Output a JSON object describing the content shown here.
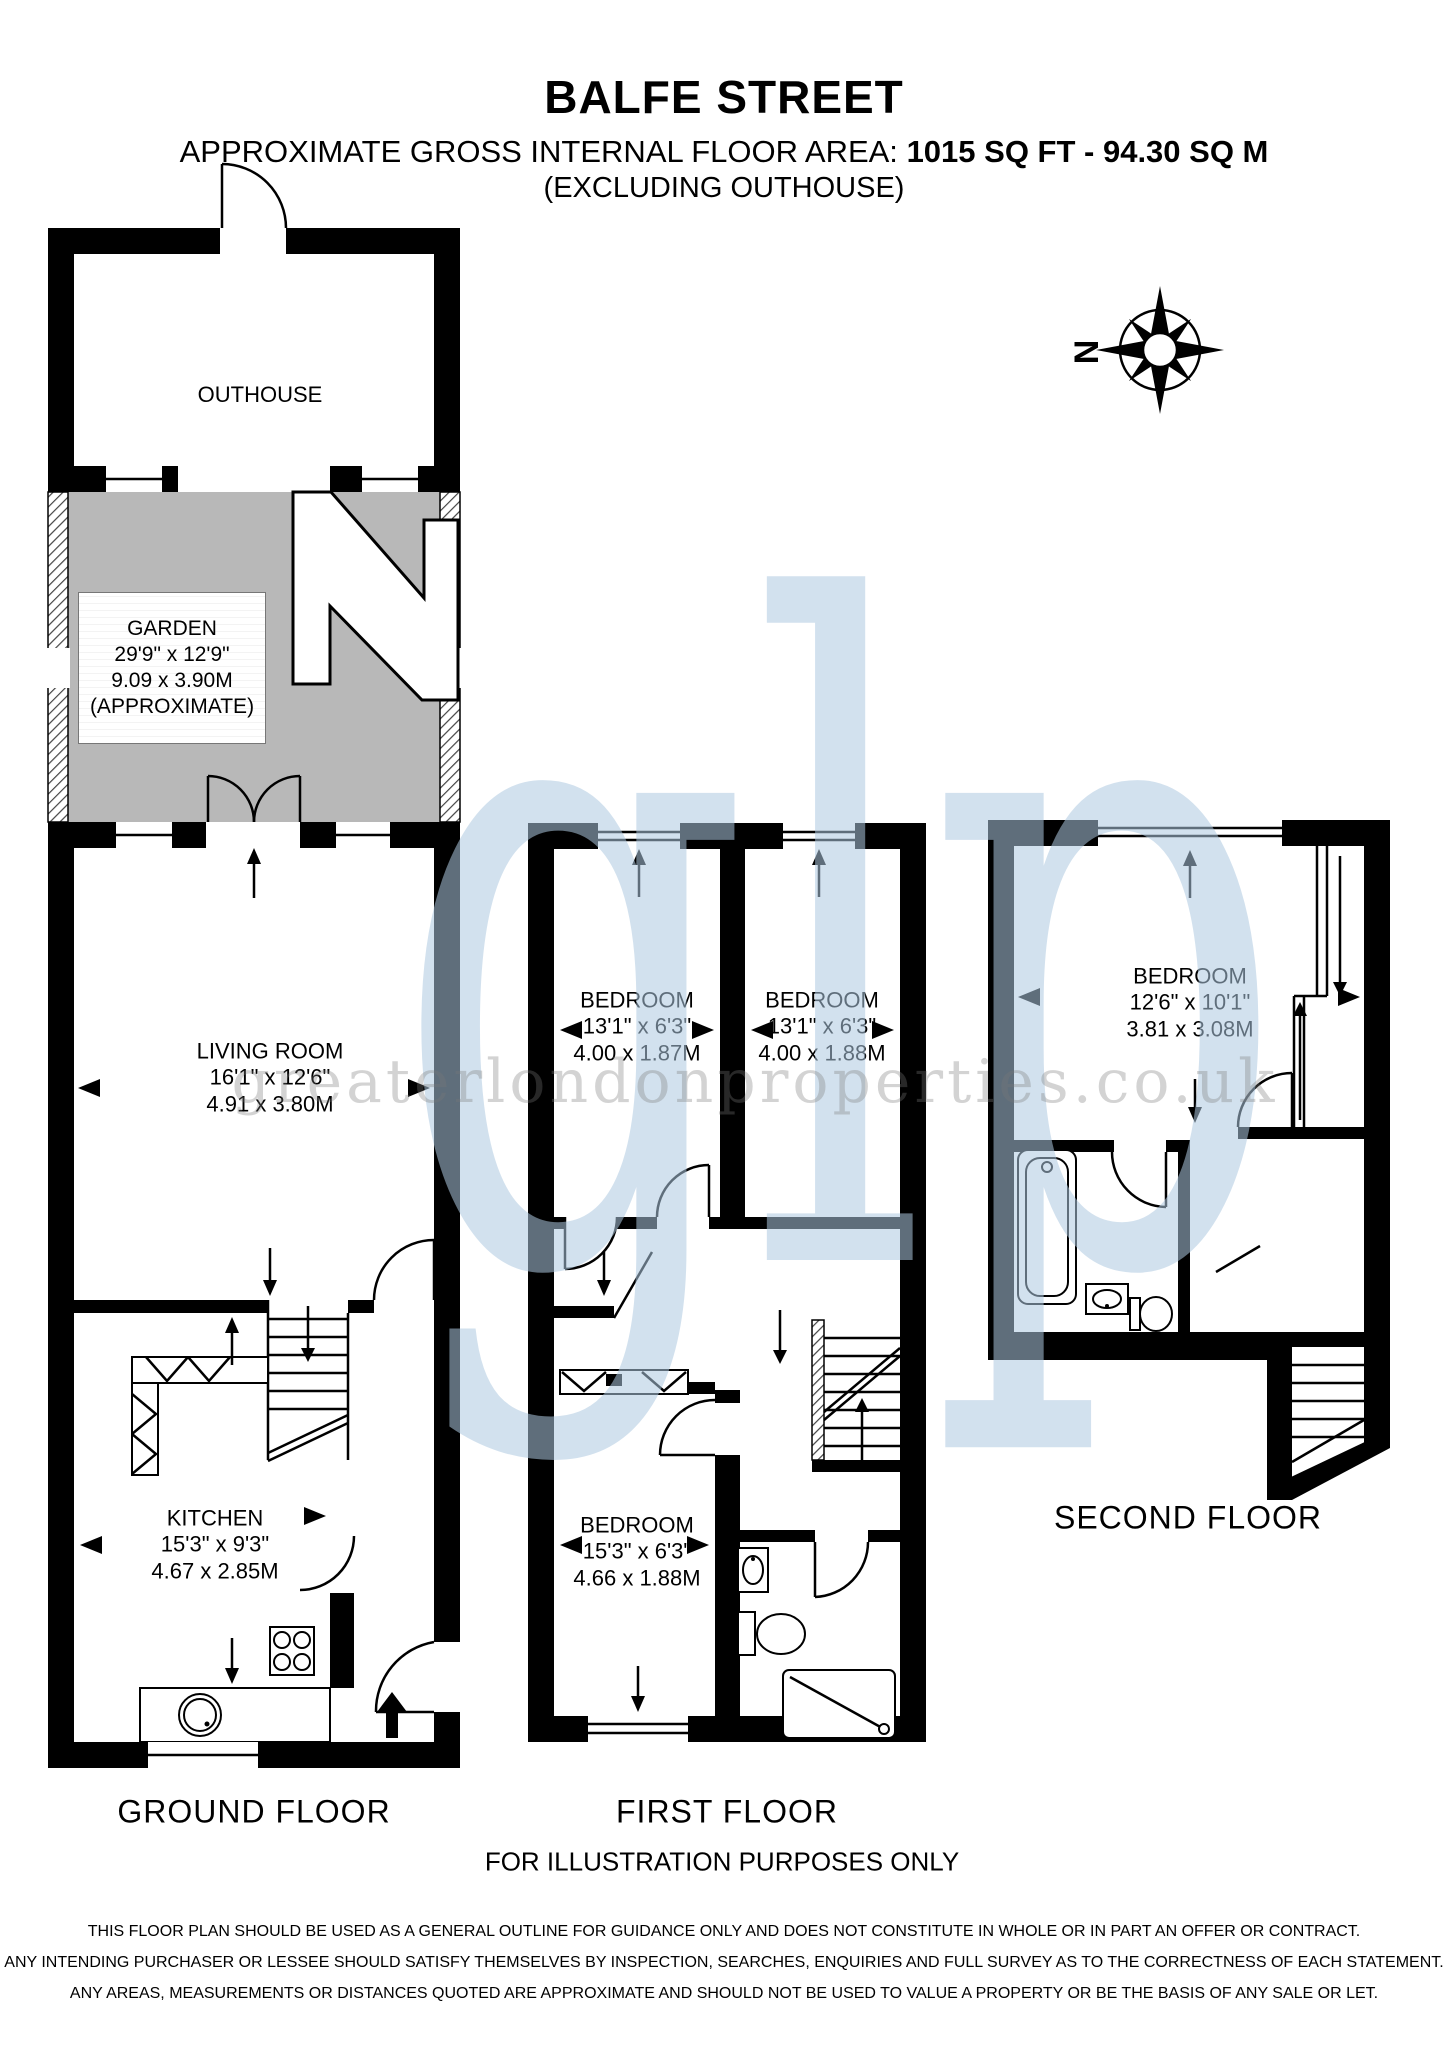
{
  "header": {
    "title": "BALFE STREET",
    "area_prefix": "APPROXIMATE GROSS INTERNAL FLOOR AREA:",
    "area_value": "1015 SQ FT - 94.30 SQ M",
    "exclusion_note": "(EXCLUDING OUTHOUSE)"
  },
  "compass": {
    "north_label": "N"
  },
  "watermark": {
    "monogram": "glp",
    "website": "greaterlondonproperties.co.uk"
  },
  "ground_floor": {
    "label": "GROUND FLOOR",
    "outhouse": {
      "name": "OUTHOUSE"
    },
    "garden": {
      "name": "GARDEN",
      "size_imperial": "29'9\" x 12'9\"",
      "size_metric": "9.09 x 3.90M",
      "note": "(APPROXIMATE)"
    },
    "living_room": {
      "name": "LIVING ROOM",
      "size_imperial": "16'1\" x 12'6\"",
      "size_metric": "4.91 x 3.80M"
    },
    "kitchen": {
      "name": "KITCHEN",
      "size_imperial": "15'3\" x 9'3\"",
      "size_metric": "4.67 x 2.85M"
    }
  },
  "first_floor": {
    "label": "FIRST FLOOR",
    "bedroom_front_left": {
      "name": "BEDROOM",
      "size_imperial": "13'1\" x 6'3\"",
      "size_metric": "4.00 x 1.87M"
    },
    "bedroom_front_right": {
      "name": "BEDROOM",
      "size_imperial": "13'1\" x 6'3\"",
      "size_metric": "4.00 x 1.88M"
    },
    "bedroom_rear": {
      "name": "BEDROOM",
      "size_imperial": "15'3\" x 6'3\"",
      "size_metric": "4.66 x 1.88M"
    }
  },
  "second_floor": {
    "label": "SECOND FLOOR",
    "bedroom": {
      "name": "BEDROOM",
      "size_imperial": "12'6\" x 10'1\"",
      "size_metric": "3.81 x 3.08M"
    }
  },
  "footer": {
    "illustration_note": "FOR ILLUSTRATION PURPOSES ONLY",
    "disclaimer_lines": [
      "THIS FLOOR PLAN SHOULD BE USED AS A GENERAL OUTLINE FOR GUIDANCE ONLY AND DOES NOT CONSTITUTE IN WHOLE OR IN PART AN OFFER OR CONTRACT.",
      "ANY INTENDING PURCHASER OR LESSEE SHOULD SATISFY THEMSELVES BY INSPECTION, SEARCHES, ENQUIRIES AND FULL SURVEY AS TO THE CORRECTNESS OF EACH STATEMENT.",
      "ANY AREAS, MEASUREMENTS OR DISTANCES QUOTED ARE APPROXIMATE AND SHOULD NOT BE USED TO VALUE A PROPERTY OR BE THE BASIS OF ANY SALE OR LET."
    ]
  }
}
